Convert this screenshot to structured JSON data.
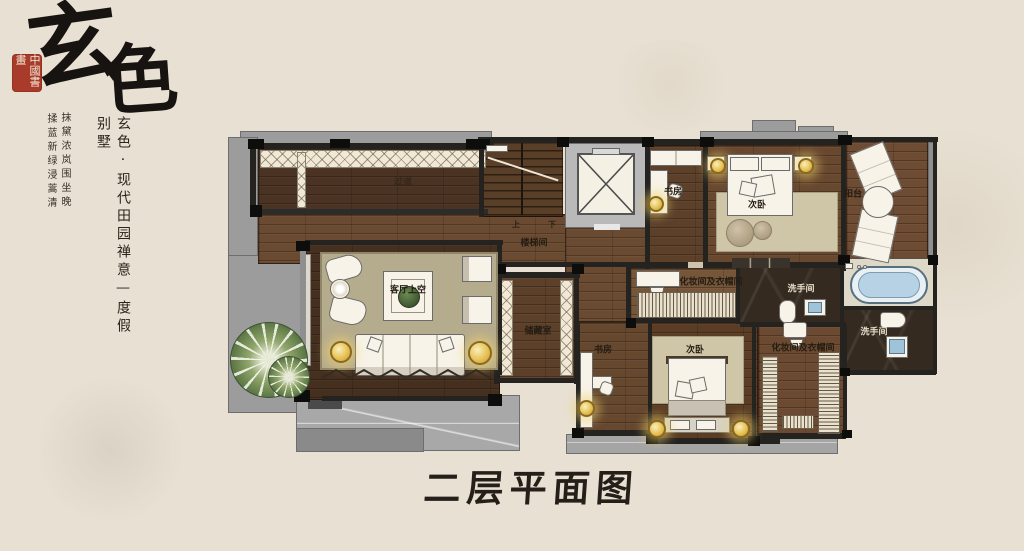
{
  "branding": {
    "calligraphy_char1": "玄",
    "calligraphy_char2": "色",
    "seal": "中國書畫",
    "tagline_vertical": "玄色·现代田园禅意—度假别墅",
    "poem_right": "抹黛浓岚围坐晚",
    "poem_left": "揉蓝新绿浸蒿清"
  },
  "plan_title": "二层平面图",
  "rooms": {
    "corridor_upper": "过道",
    "stairwell": "楼梯间",
    "study_top": "书房",
    "bedroom_top": "次卧",
    "balcony": "阳台",
    "dressing_top": "化妆间及衣帽间",
    "washroom_mid": "洗手间",
    "living_void": "客厅上空",
    "storage": "储藏室",
    "study_bottom": "书房",
    "bedroom_bottom": "次卧",
    "dressing_bottom": "化妆间及衣帽间",
    "washroom_right": "洗手间"
  },
  "stairs": {
    "up": "上",
    "down": "下"
  },
  "colors": {
    "background": "#e8e0d2",
    "ink": "#201b15",
    "seal_red": "#a93b2a",
    "terrace": "#9c9c9c",
    "marble": "#342a20",
    "rug": "#b5ab8d",
    "accent_gold": "#e3b13e",
    "bath_blue": "#b7d2e4",
    "plant_green": "#6f8757"
  }
}
